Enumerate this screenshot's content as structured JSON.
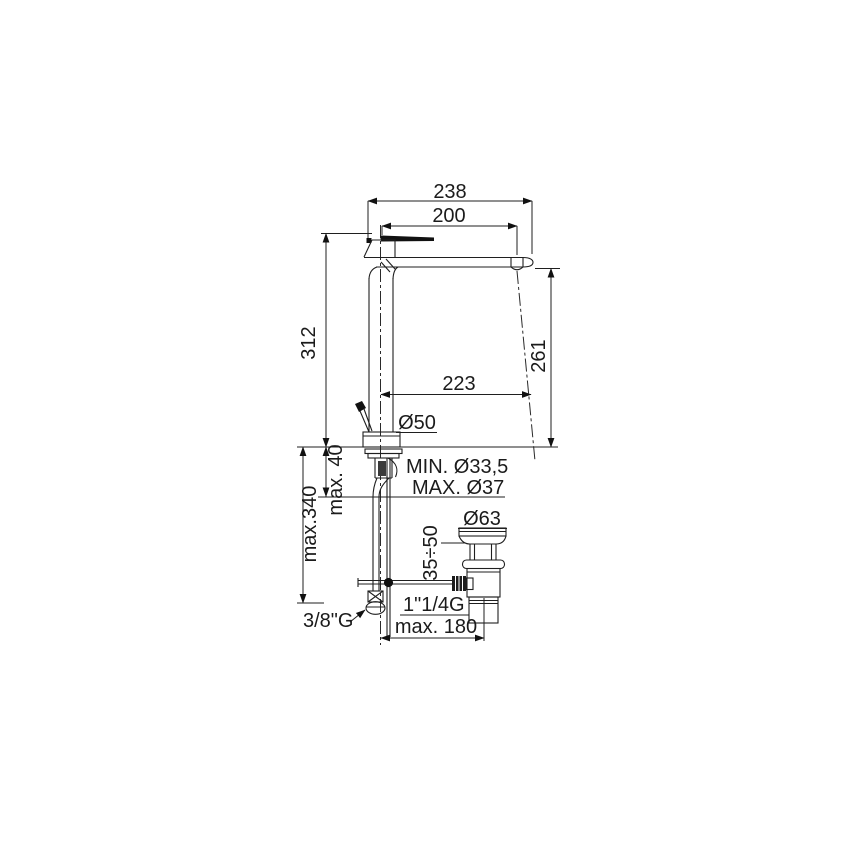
{
  "figure": {
    "description": "Technical dimension drawing of a tall single-lever basin mixer tap with pop-up waste"
  },
  "labels": {
    "overall_width": "238",
    "spout_reach": "200",
    "body_height": "312",
    "spout_height": "261",
    "outlet_offset": "223",
    "base_diameter": "Ø50",
    "min_hole": "MIN. Ø33,5",
    "max_hole": "MAX. Ø37",
    "deck_thickness": "max. 40",
    "hose_reach": "max.340",
    "supply_thread": "3/8\"G",
    "waste_cap_diameter": "Ø63",
    "waste_adjust": "35÷50",
    "waste_thread": "1\"1/4G",
    "waste_offset": "max. 180"
  }
}
